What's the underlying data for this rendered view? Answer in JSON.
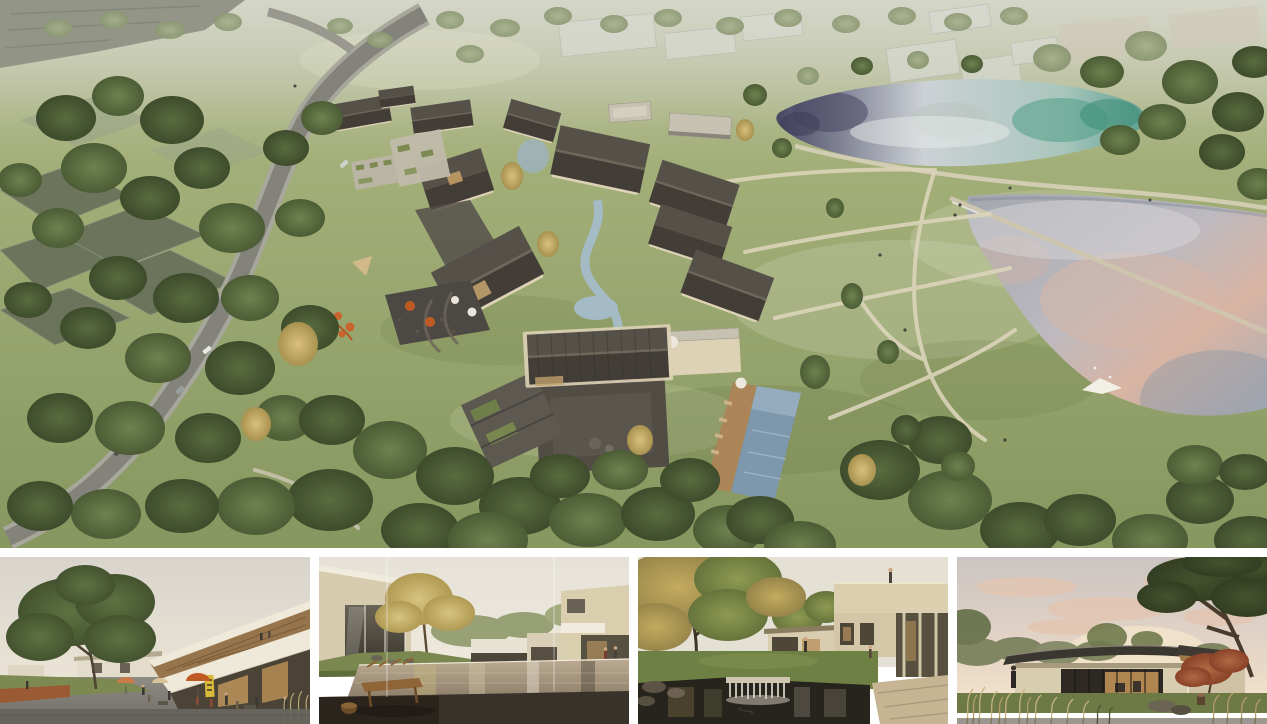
{
  "page": {
    "background": "#ffffff"
  },
  "hero": {
    "label": "Aerial rendering of a courtyard resort village with winding road, stream, swimming pool and two ponds"
  },
  "thumbnails": [
    {
      "label": "Street-level rendering of village plaza with large tree, cafe umbrellas and shop sign"
    },
    {
      "label": "Courtyard rendering with reflecting pool, wooden bench and yellow tree"
    },
    {
      "label": "Garden courtyard rendering with pond, waterfall weir and cantilevered building"
    },
    {
      "label": "Low glass pavilion rendering at dusk with red maple and tall grasses"
    }
  ],
  "palette": {
    "background": "#ffffff",
    "haze": "#c6c8b2",
    "grass": "#a3af78",
    "grass_deep": "#879760",
    "canopy": "#4e5f36",
    "canopy_light": "#6d7f4b",
    "wall": "#ddd2b6",
    "roof_dark": "#423e37",
    "roof_light": "#555048",
    "flat_roof": "#c6c1b0",
    "stone_court": "#514c44",
    "road": "#83837b",
    "road_shoulder": "#a7a79b",
    "trail": "#dcd4ba",
    "water_navy": "#474763",
    "water_silver": "#ccd1d5",
    "water_teal": "#5ea08e",
    "lake_lilac": "#bcb9bf",
    "lake_pink": "#d8b4a3",
    "pool_blue": "#7d97ad",
    "stream": "#a4bac4",
    "deck_wood": "#ab8458",
    "umbrella_orange": "#c05a24",
    "play_orange": "#c9652c",
    "sign_yellow": "#d9b93a",
    "bench_wood": "#8f6436",
    "autumn_leaf": "#c3ab5e",
    "maple_red": "#9d5032",
    "dusk_sky": "#e9d9c6",
    "dusk_cloud": "#e5c4ae"
  }
}
